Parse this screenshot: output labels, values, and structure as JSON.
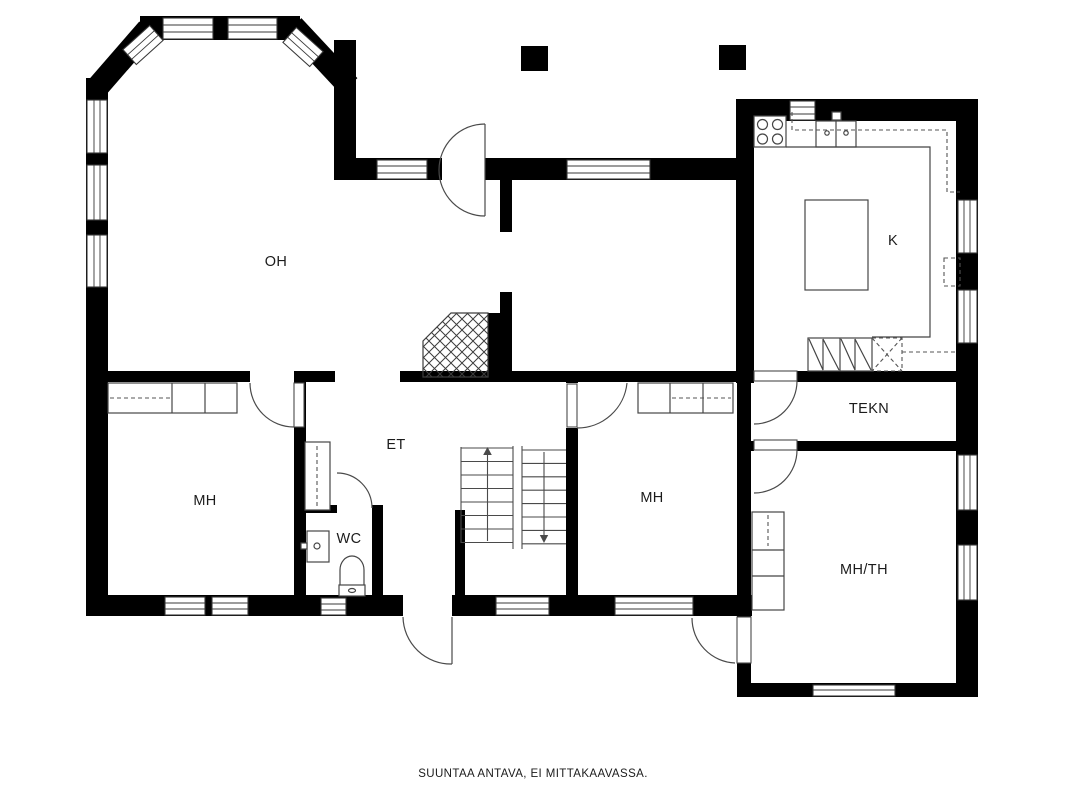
{
  "caption": "SUUNTAA ANTAVA, EI MITTAKAAVASSA.",
  "rooms": {
    "oh": {
      "label": "OH"
    },
    "k": {
      "label": "K"
    },
    "tekn": {
      "label": "TEKN"
    },
    "et": {
      "label": "ET"
    },
    "mh_left": {
      "label": "MH"
    },
    "mh_right": {
      "label": "MH"
    },
    "wc": {
      "label": "WC"
    },
    "mh_th": {
      "label": "MH/TH"
    }
  },
  "colors": {
    "wall": "#000000",
    "background": "#ffffff",
    "fixture_line": "#454545"
  },
  "icons": [
    "stove-icon",
    "sink-icon",
    "kitchen-island-icon",
    "appliance-icon",
    "fireplace-icon",
    "staircase-icon",
    "wardrobe-icon",
    "closet-icon",
    "toilet-icon",
    "washbasin-icon",
    "door-arc-icon",
    "window-icon",
    "pillar-icon"
  ]
}
